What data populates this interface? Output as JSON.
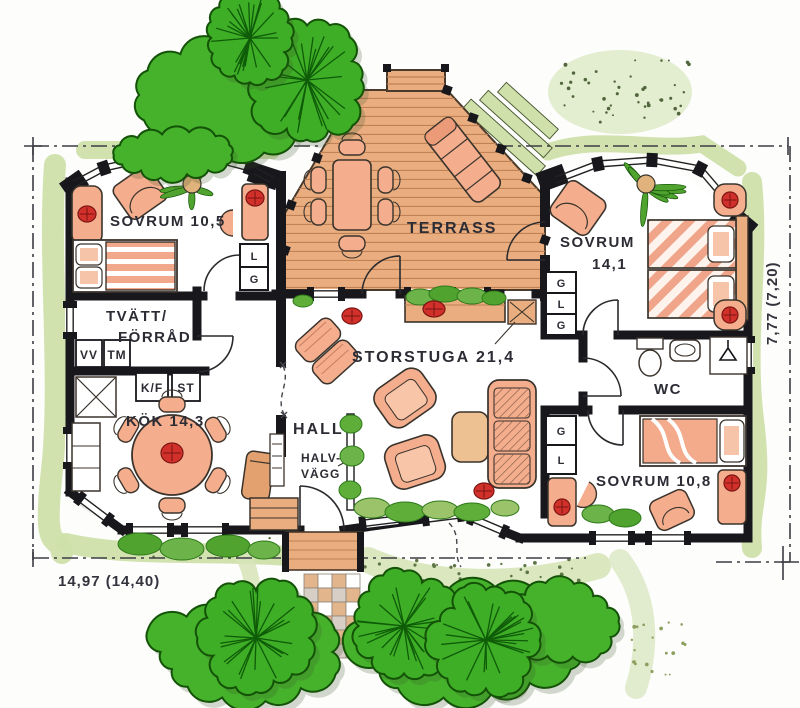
{
  "rooms": {
    "sovrum1": {
      "label": "SOVRUM 10,5"
    },
    "tvatt": {
      "line1": "TVÄTT/",
      "line2": "FÖRRÅD"
    },
    "kok": {
      "label": "KÖK 14,3"
    },
    "terrass": {
      "label": "TERRASS"
    },
    "sovrum2": {
      "line1": "SOVRUM",
      "line2": "14,1"
    },
    "storstuga": {
      "label": "STORSTUGA 21,4"
    },
    "hall": {
      "label": "HALL"
    },
    "halvvagg": {
      "line1": "HALV-",
      "line2": "VÄGG"
    },
    "wc": {
      "label": "WC"
    },
    "sovrum3": {
      "label": "SOVRUM 10,8"
    }
  },
  "appliances": {
    "vv": "VV",
    "tm": "TM",
    "kf": "K/F",
    "st": "ST"
  },
  "closets": {
    "sovrum1": [
      "L",
      "G"
    ],
    "sovrum2": [
      "G",
      "L",
      "G"
    ],
    "sovrum3": [
      "G",
      "L"
    ]
  },
  "dimensions": {
    "width": "14,97 (14,40)",
    "height": "7,77 (7,20)"
  },
  "colors": {
    "wall": "#17171c",
    "wood": "#e9ad80",
    "wood_line": "#c08154",
    "furniture": "#f4ae8e",
    "tree": "#3fae27",
    "bush": "#46b22c",
    "tree_line": "#0f5c08",
    "garden_band": "#cfe0ab",
    "accent_red": "#d2302a",
    "text": "#2c2c35"
  }
}
